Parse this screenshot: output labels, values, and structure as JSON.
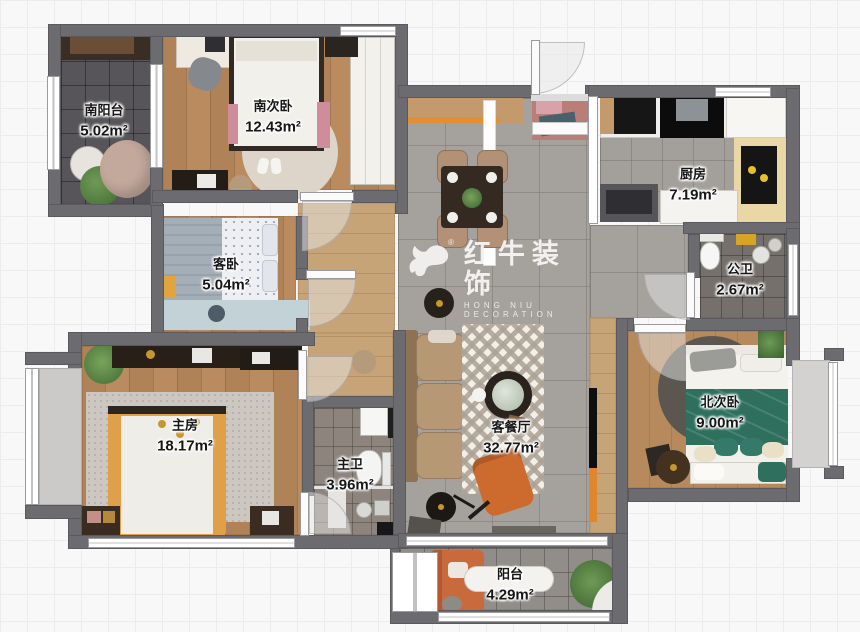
{
  "watermark": {
    "brand": "红牛装饰",
    "registered": "®",
    "subtitle": "HONG NIU DECORATION",
    "logo_icon": "bull-logo",
    "color": "#ffffff"
  },
  "rooms": [
    {
      "id": "south-balcony",
      "name": "南阳台",
      "area": "5.02m²"
    },
    {
      "id": "south-bedroom",
      "name": "南次卧",
      "area": "12.43m²"
    },
    {
      "id": "guest-bedroom",
      "name": "客卧",
      "area": "5.04m²"
    },
    {
      "id": "master-bedroom",
      "name": "主房",
      "area": "18.17m²"
    },
    {
      "id": "master-bath",
      "name": "主卫",
      "area": "3.96m²"
    },
    {
      "id": "living-dining",
      "name": "客餐厅",
      "area": "32.77m²"
    },
    {
      "id": "kitchen",
      "name": "厨房",
      "area": "7.19m²"
    },
    {
      "id": "public-bath",
      "name": "公卫",
      "area": "2.67m²"
    },
    {
      "id": "north-bedroom",
      "name": "北次卧",
      "area": "9.00m²"
    },
    {
      "id": "balcony",
      "name": "阳台",
      "area": "4.29m²"
    }
  ],
  "colors": {
    "wall": "#6c6b6f",
    "accent_orange": "#ce6a2e",
    "bed_green": "#2e6f5e",
    "bed_yellow": "#dfa049",
    "kitchen_counter": "#e9d8a6"
  }
}
